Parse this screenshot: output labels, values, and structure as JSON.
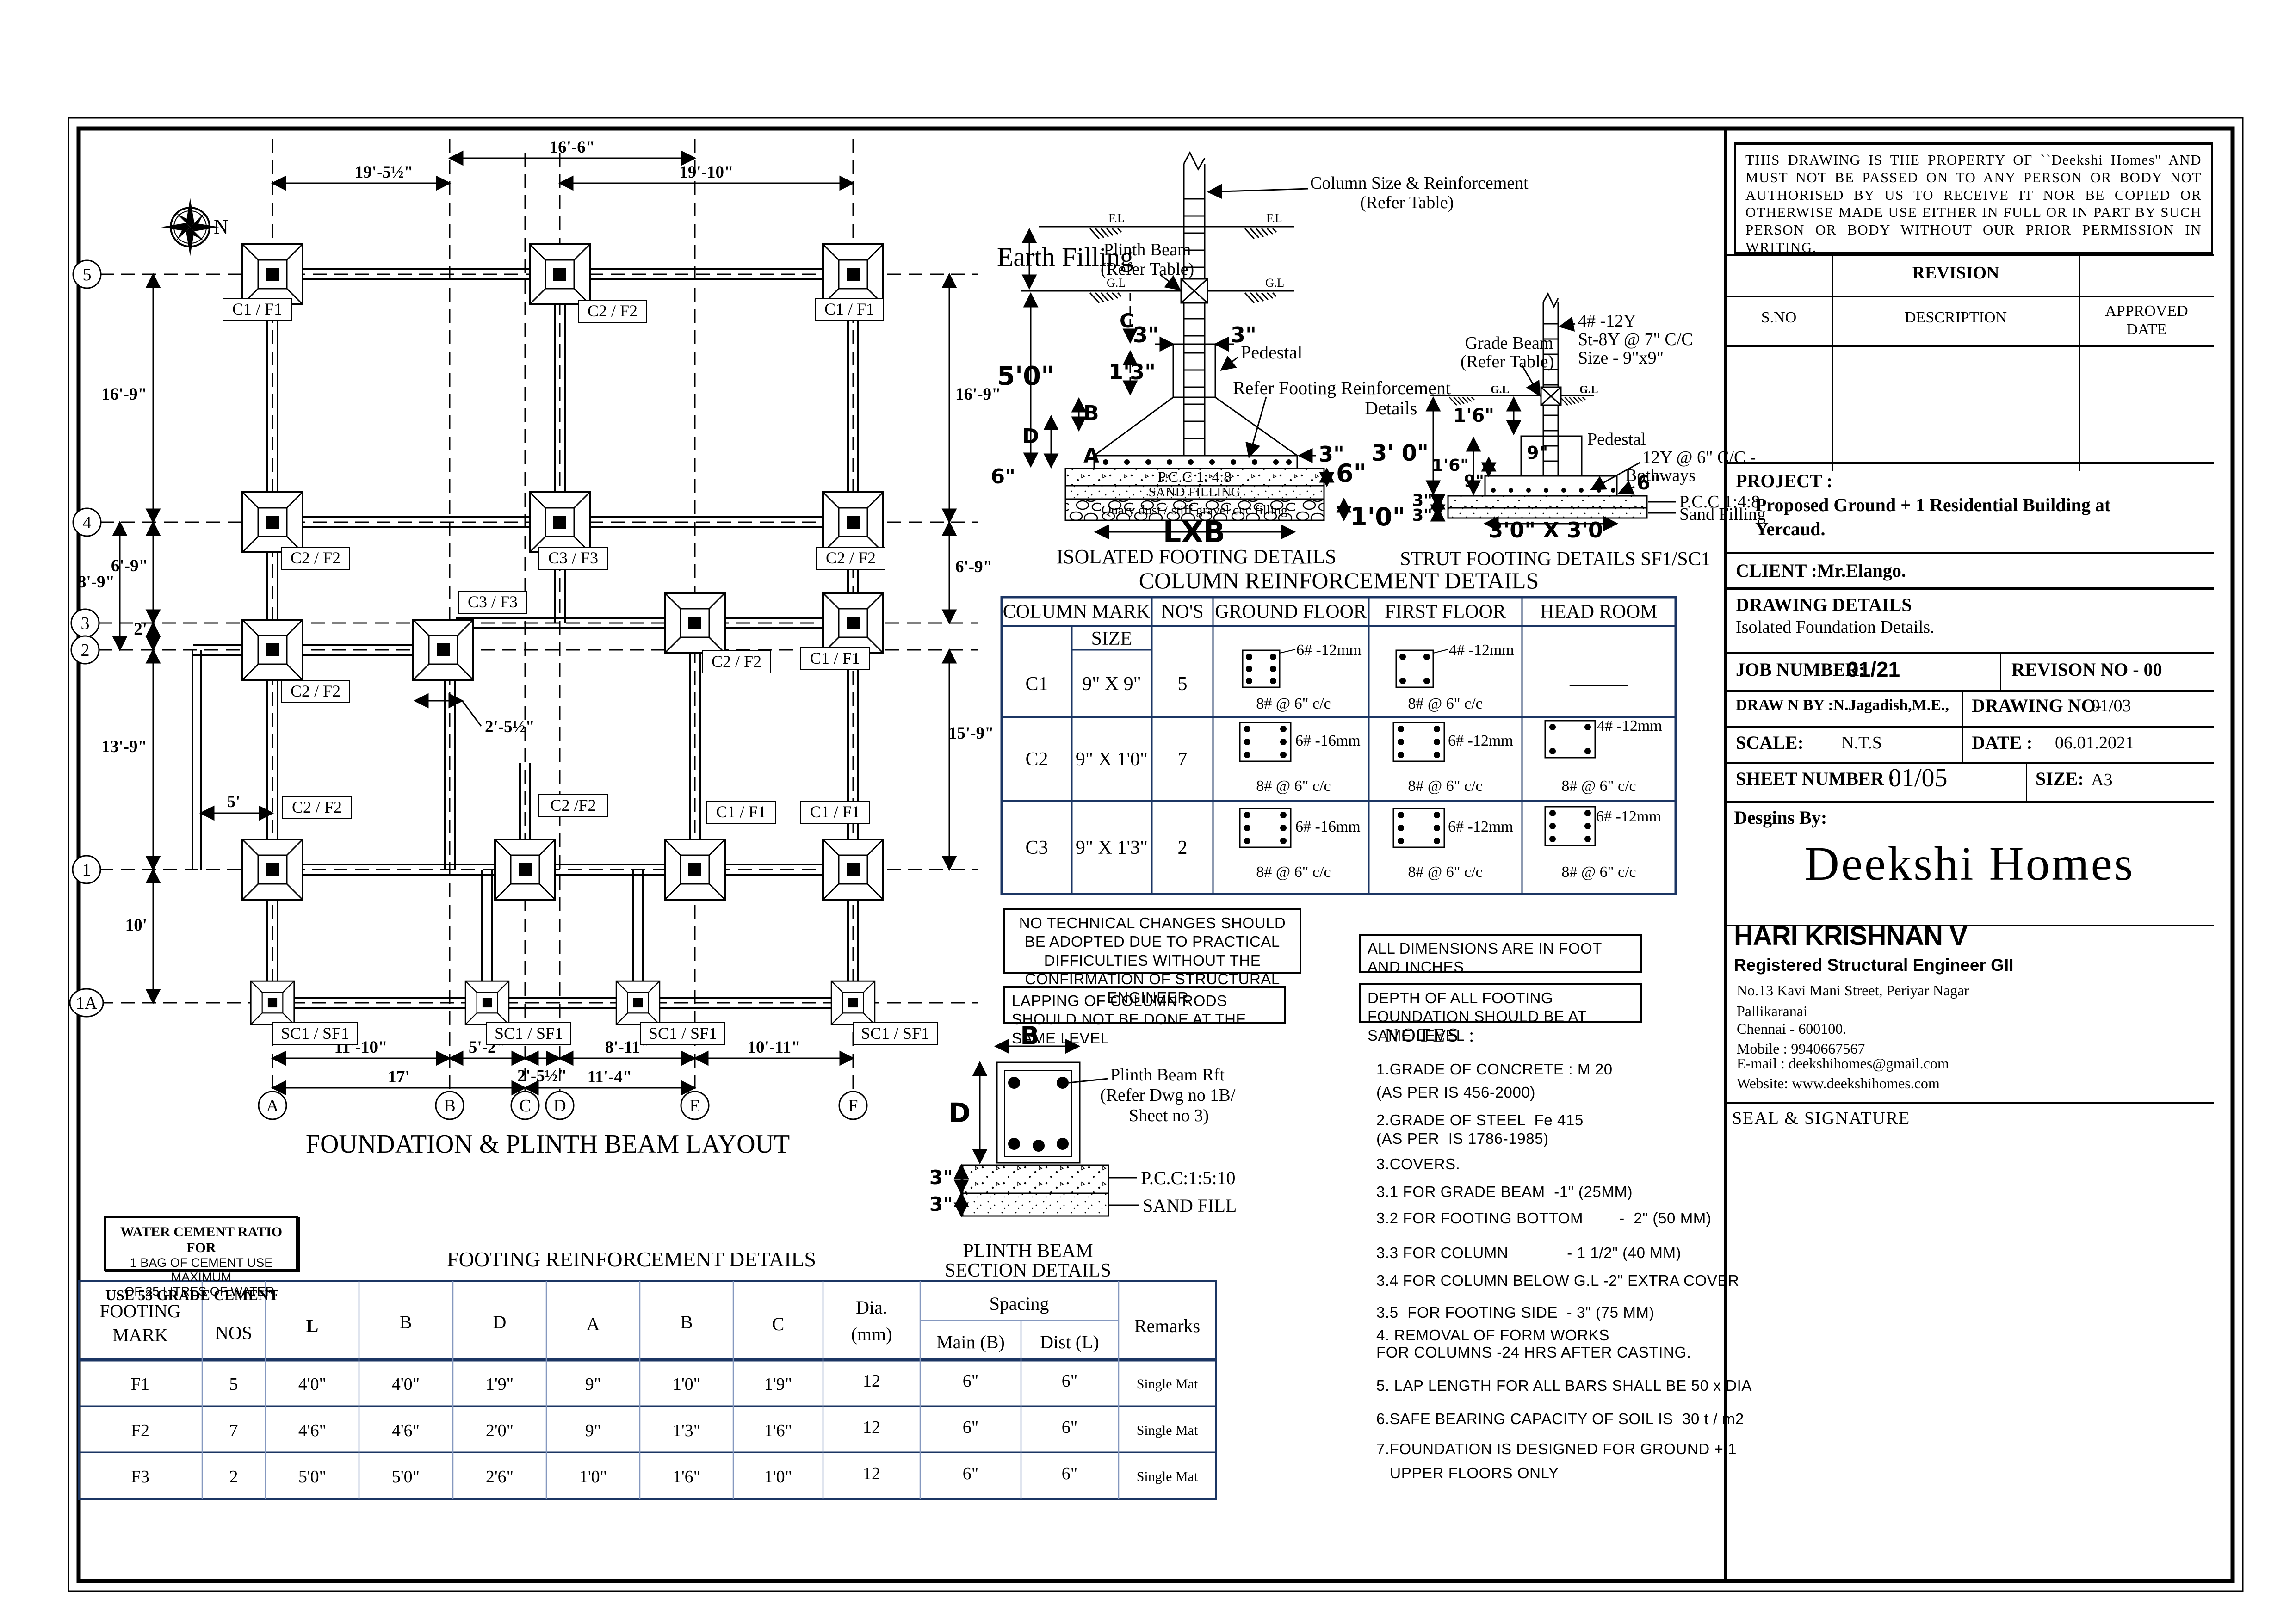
{
  "plan": {
    "title": "FOUNDATION & PLINTH BEAM LAYOUT",
    "north": "N",
    "rows": [
      "5",
      "4",
      "3",
      "2",
      "1",
      "1A"
    ],
    "cols": [
      "A",
      "B",
      "C",
      "D",
      "E",
      "F"
    ],
    "dt1": "16'-6\"",
    "dt2": "19'-5½\"",
    "dt3": "19'-10\"",
    "dl1": "16'-9\"",
    "dl2": "6'-9\"",
    "dl3": "8'-9\"",
    "dl4": "2'",
    "dl5": "13'-9\"",
    "dl6": "10'",
    "dl7": "5'",
    "dr1": "16'-9\"",
    "dr2": "6'-9\"",
    "dr3": "15'-9\"",
    "db1": "11'-10\"",
    "db2": "5'-2\"",
    "db3": "2'-5½\"",
    "db4": "8'-11\"",
    "db5": "10'-11\"",
    "db6": "17'",
    "db7": "11'-4\"",
    "doff": "2'-5½\"",
    "flabels": [
      "C1 / F1",
      "C2 / F2",
      "C1 / F1",
      "C2 / F2",
      "C3 / F3",
      "C2 / F2",
      "C3 / F3",
      "C2 / F2",
      "C1 / F1",
      "C2 / F2",
      "C2 / F2",
      "C2 /F2",
      "C1 / F1",
      "C1 / F1",
      "SC1 / SF1",
      "SC1 / SF1",
      "SC1 / SF1",
      "SC1 / SF1"
    ]
  },
  "iso": {
    "title": "ISOLATED FOOTING DETAILS",
    "earth": "Earth Filling",
    "coln1": "Column Size & Reinforcement",
    "coln2": "(Refer Table)",
    "plb1": "Plinth Beam",
    "plb2": "(Refer Table)",
    "fl": "F.L",
    "gl": "G.L",
    "c": "C",
    "d13": "1'3\"",
    "d3a": "3\"",
    "d3b": "3\"",
    "d50": "5'0\"",
    "b": "B",
    "d": "D",
    "a": "A",
    "d6l": "6\"",
    "ped": "Pedestal",
    "ref1": "Refer Footing Reinforcement",
    "ref2": "Details",
    "d3r": "3\"",
    "d6r": "6\"",
    "d10": "1'0\"",
    "pcc": "P.C.C  1: 4:8",
    "sand": "SAND FILLING",
    "gravel": "Quary dust / stiff  gravel cnc filling",
    "lxb": "LXB"
  },
  "strut": {
    "title": "STRUT FOOTING DETAILS SF1/SC1",
    "gb1": "Grade Beam",
    "gb2": "(Refer Table)",
    "r1": "4# -12Y",
    "r2": "St-8Y @ 7\" C/C",
    "r3": "Size - 9\"x9\"",
    "gl": "G.L",
    "d16a": "1'6\"",
    "d30": "3' 0\"",
    "d9a": "9\"",
    "d16b": "1'6\"",
    "d9b": "9\"",
    "d3a": "3\"",
    "d3b": "3\"",
    "ped": "Pedestal",
    "mesh1": "12Y @ 6\" C/C -",
    "mesh2": "Bothways",
    "d6": "6\"",
    "pcc": "P.C.C  1:4:8",
    "sand": "Sand Filling",
    "base": "3'0\" X 3'0\""
  },
  "plinth": {
    "t1": "PLINTH BEAM",
    "t2": "SECTION DETAILS",
    "b": "B",
    "d": "D",
    "d3a": "3\"",
    "d3b": "3\"",
    "rft1": "Plinth Beam Rft",
    "rft2": "(Refer Dwg no 1B/",
    "rft3": "Sheet no 3)",
    "pcc": "P.C.C:1:5:10",
    "sand": "SAND FILL"
  },
  "ct": {
    "title": "COLUMN REINFORCEMENT DETAILS",
    "h_mark": "COLUMN  MARK",
    "h_size": "SIZE",
    "h_nos": "NO'S",
    "h_gf": "GROUND FLOOR",
    "h_ff": "FIRST FLOOR",
    "h_hr": "HEAD ROOM",
    "dash": "———",
    "rows": [
      {
        "mark": "C1",
        "size": "9\" X 9\"",
        "nos": "5",
        "gf_b": "6# -12mm",
        "gf_t": "8# @ 6\" c/c",
        "ff_b": "4# -12mm",
        "ff_t": "8# @ 6\" c/c",
        "hr_b": "",
        "hr_t": ""
      },
      {
        "mark": "C2",
        "size": "9\" X 1'0\"",
        "nos": "7",
        "gf_b": "6# -16mm",
        "gf_t": "8# @ 6\" c/c",
        "ff_b": "6# -12mm",
        "ff_t": "8# @ 6\" c/c",
        "hr_b": "4# -12mm",
        "hr_t": "8# @ 6\" c/c"
      },
      {
        "mark": "C3",
        "size": "9\" X 1'3\"",
        "nos": "2",
        "gf_b": "6# -16mm",
        "gf_t": "8# @ 6\" c/c",
        "ff_b": "6# -12mm",
        "ff_t": "8# @ 6\" c/c",
        "hr_b": "6# -12mm",
        "hr_t": "8# @ 6\" c/c"
      }
    ]
  },
  "ft": {
    "title": "FOOTING REINFORCEMENT DETAILS",
    "h1": "FOOTING",
    "h1b": "MARK",
    "h2": "NOS",
    "h3": "L",
    "h4": "B",
    "h5": "D",
    "h6": "A",
    "h7": "B",
    "h8": "C",
    "h9a": "Dia.",
    "h9b": "(mm)",
    "h10": "Spacing",
    "h10a": "Main (B)",
    "h10b": "Dist (L)",
    "h11": "Remarks",
    "rows": [
      [
        "F1",
        "5",
        "4'0\"",
        "4'0\"",
        "1'9\"",
        "9\"",
        "1'0\"",
        "1'9\"",
        "12",
        "6\"",
        "6\"",
        "Single Mat"
      ],
      [
        "F2",
        "7",
        "4'6\"",
        "4'6\"",
        "2'0\"",
        "9\"",
        "1'3\"",
        "1'6\"",
        "12",
        "6\"",
        "6\"",
        "Single Mat"
      ],
      [
        "F3",
        "2",
        "5'0\"",
        "5'0\"",
        "2'6\"",
        "1'0\"",
        "1'6\"",
        "1'0\"",
        "12",
        "6\"",
        "6\"",
        "Single Mat"
      ]
    ]
  },
  "notes": {
    "box1": "NO TECHNICAL CHANGES SHOULD BE ADOPTED DUE TO PRACTICAL DIFFICULTIES WITHOUT THE CONFIRMATION OF STRUCTURAL ENGINEER .",
    "box2": "LAPPING OF COLUMN RODS SHOULD NOT BE DONE AT THE SAME LEVEL",
    "box3": "ALL DIMENSIONS ARE IN FOOT AND INCHES",
    "box4": "DEPTH OF ALL FOOTING FOUNDATION SHOULD BE AT SAME LEVEL",
    "heading": "NOTES :",
    "items": [
      "1.GRADE OF CONCRETE : M 20",
      "(AS PER IS 456-2000)",
      "2.GRADE OF STEEL  Fe 415",
      "(AS PER  IS 1786-1985)",
      "3.COVERS.",
      "3.1 FOR GRADE BEAM  -1\" (25MM)",
      "3.2 FOR FOOTING BOTTOM        -  2\" (50 MM)",
      "3.3 FOR COLUMN             - 1 1/2\" (40 MM)",
      "3.4 FOR COLUMN BELOW G.L -2\" EXTRA COVER",
      "3.5  FOR FOOTING SIDE  - 3\" (75 MM)",
      "4. REMOVAL OF FORM WORKS",
      "FOR COLUMNS -24 HRS AFTER CASTING.",
      "5. LAP LENGTH FOR ALL BARS SHALL BE 50 x DIA",
      "6.SAFE BEARING CAPACITY OF SOIL IS  30 t / m2",
      "7.FOUNDATION IS DESIGNED FOR GROUND + 1",
      "   UPPER FLOORS ONLY"
    ],
    "wcr1": "WATER CEMENT RATIO  FOR",
    "wcr2": "1 BAG OF CEMENT USE MAXIMUM",
    "wcr3": "OF 25 LITRES OF WATER.",
    "use53": "USE 53 GRADE CEMENT"
  },
  "tb": {
    "disclaimer": "THIS DRAWING IS THE PROPERTY OF ``Deekshi Homes'' AND MUST NOT BE PASSED ON TO ANY PERSON OR BODY NOT AUTHORISED BY US TO RECEIVE IT NOR BE COPIED OR OTHERWISE MADE USE EITHER IN FULL OR IN PART BY SUCH PERSON OR BODY WITHOUT OUR PRIOR PERMISSION IN WRITING.",
    "revision": "REVISION",
    "sno": "S.NO",
    "description": "DESCRIPTION",
    "approved1": "APPROVED",
    "approved2": "DATE",
    "project_label": "PROJECT :",
    "project1": "Proposed Ground + 1 Residential  Building at",
    "project2": "Yercaud.",
    "client": "CLIENT :Mr.Elango.",
    "dd_label": "DRAWING DETAILS",
    "dd_value": "Isolated Foundation Details.",
    "job_label": "JOB NUMBER:",
    "job_value": "01/21",
    "revno": "REVISON NO  - 00",
    "drawn": "DRAW N BY :N.Jagadish,M.E.,",
    "dno_label": "DRAWING NO-",
    "dno_value": "01/03",
    "scale_label": "SCALE:",
    "scale_value": "N.T.S",
    "date_label": "DATE :",
    "date_value": "06.01.2021",
    "sheet_label": "SHEET NUMBER :",
    "sheet_value": "01/05",
    "size_label": "SIZE:",
    "size_value": "A3",
    "designs_by": "Desgins By:",
    "logo": "Deekshi Homes",
    "name": "HARI KRISHNAN V",
    "etitle": "Registered Structural Engineer GII",
    "address": [
      "No.13 Kavi Mani Street, Periyar Nagar",
      "Pallikaranai",
      "Chennai - 600100.",
      "Mobile : 9940667567",
      "E-mail : deekshihomes@gmail.com",
      "Website: www.deekshihomes.com"
    ],
    "seal": "SEAL & SIGNATURE"
  }
}
